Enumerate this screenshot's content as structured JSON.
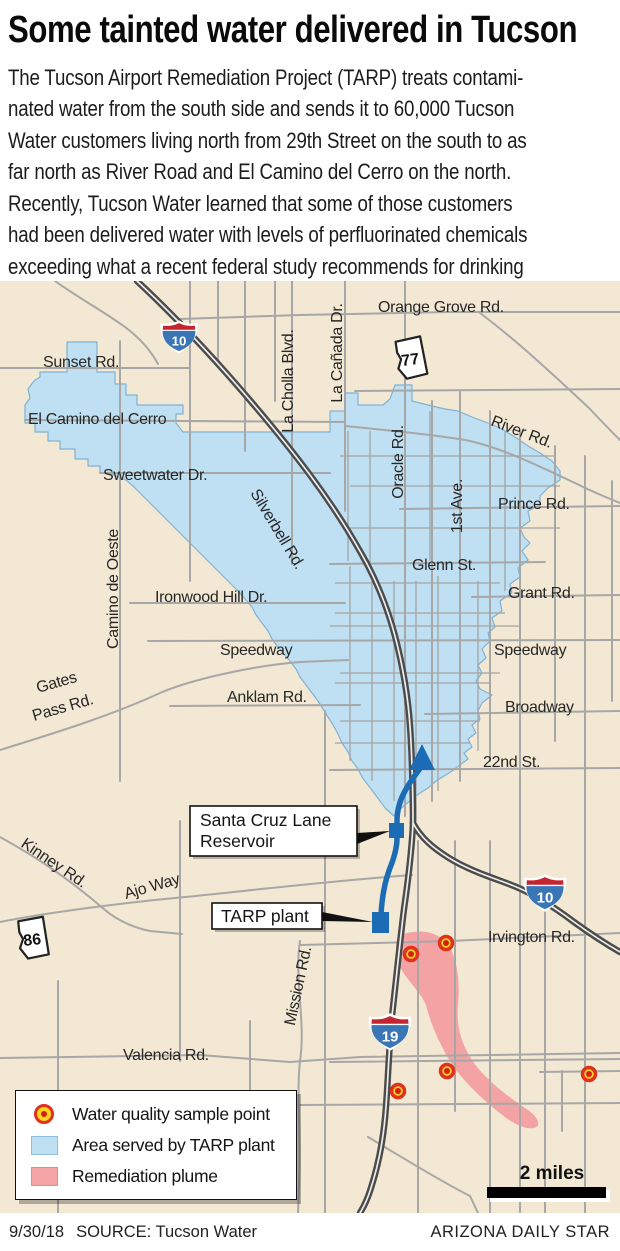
{
  "header": {
    "title": "Some tainted water delivered in Tucson",
    "body_lines": [
      "The Tucson Airport Remediation Project (TARP) treats contami-",
      "nated water from the south side and sends it to 60,000 Tucson",
      "Water customers living north from 29th Street on the south to as",
      "far north as River Road and El Camino del Cerro on the north.",
      "Recently, Tucson Water learned that some of those customers",
      "had been delivered water with levels of perfluorinated chemicals",
      "exceeding what a recent federal study recommends for drinking",
      "water."
    ]
  },
  "map": {
    "labels": {
      "orange_grove": "Orange Grove Rd.",
      "sunset": "Sunset Rd.",
      "el_camino": "El Camino del Cerro",
      "sweetwater": "Sweetwater Dr.",
      "la_cholla": "La Cholla Blvd.",
      "la_canada": "La Cañada Dr.",
      "oracle": "Oracle Rd.",
      "river": "River Rd.",
      "prince": "Prince Rd.",
      "first_ave": "1st Ave.",
      "glenn": "Glenn St.",
      "grant": "Grant Rd.",
      "ironwood": "Ironwood Hill Dr.",
      "speedway_west": "Speedway",
      "speedway_east": "Speedway",
      "anklam": "Anklam Rd.",
      "broadway": "Broadway",
      "silverbell": "Silverbell Rd.",
      "camino_de_oeste": "Camino de Oeste",
      "gates_pass_line1": "Gates",
      "gates_pass_line2": "Pass Rd.",
      "twenty_second": "22nd St.",
      "kinney": "Kinney Rd.",
      "ajo": "Ajo Way",
      "mission": "Mission Rd.",
      "irvington": "Irvington Rd.",
      "valencia": "Valencia Rd."
    },
    "shields": {
      "i10": "10",
      "i19": "19",
      "sr77": "77",
      "sr86": "86"
    },
    "callouts": {
      "reservoir_line1": "Santa Cruz Lane",
      "reservoir_line2": "Reservoir",
      "tarp": "TARP plant"
    },
    "scale_label": "2 miles",
    "sample_points": [
      {
        "x": 411,
        "y": 673
      },
      {
        "x": 446,
        "y": 662
      },
      {
        "x": 447,
        "y": 790
      },
      {
        "x": 398,
        "y": 810
      },
      {
        "x": 589,
        "y": 793
      }
    ]
  },
  "legend": {
    "items": [
      {
        "label": "Water quality sample point",
        "type": "sample-point"
      },
      {
        "label": "Area served by TARP plant",
        "type": "service-area"
      },
      {
        "label": "Remediation plume",
        "type": "plume"
      }
    ]
  },
  "footer": {
    "date": "9/30/18",
    "source": "SOURCE: Tucson Water",
    "credit": "ARIZONA DAILY STAR"
  },
  "colors": {
    "map_background": "#f3e8d3",
    "service_area_fill": "#bfe0f2",
    "service_area_edge": "#7fb2d4",
    "plume_fill": "#f3a3a3",
    "route_blue": "#1c6cb5",
    "highway_dark": "#4b4b4b",
    "road_gray": "#a7a7a7",
    "interstate_blue": "#3a76b5",
    "interstate_red": "#c4252e",
    "sample_ring": "#e0301e",
    "sample_fill": "#ffd41e",
    "sample_center": "#cf1f16"
  }
}
